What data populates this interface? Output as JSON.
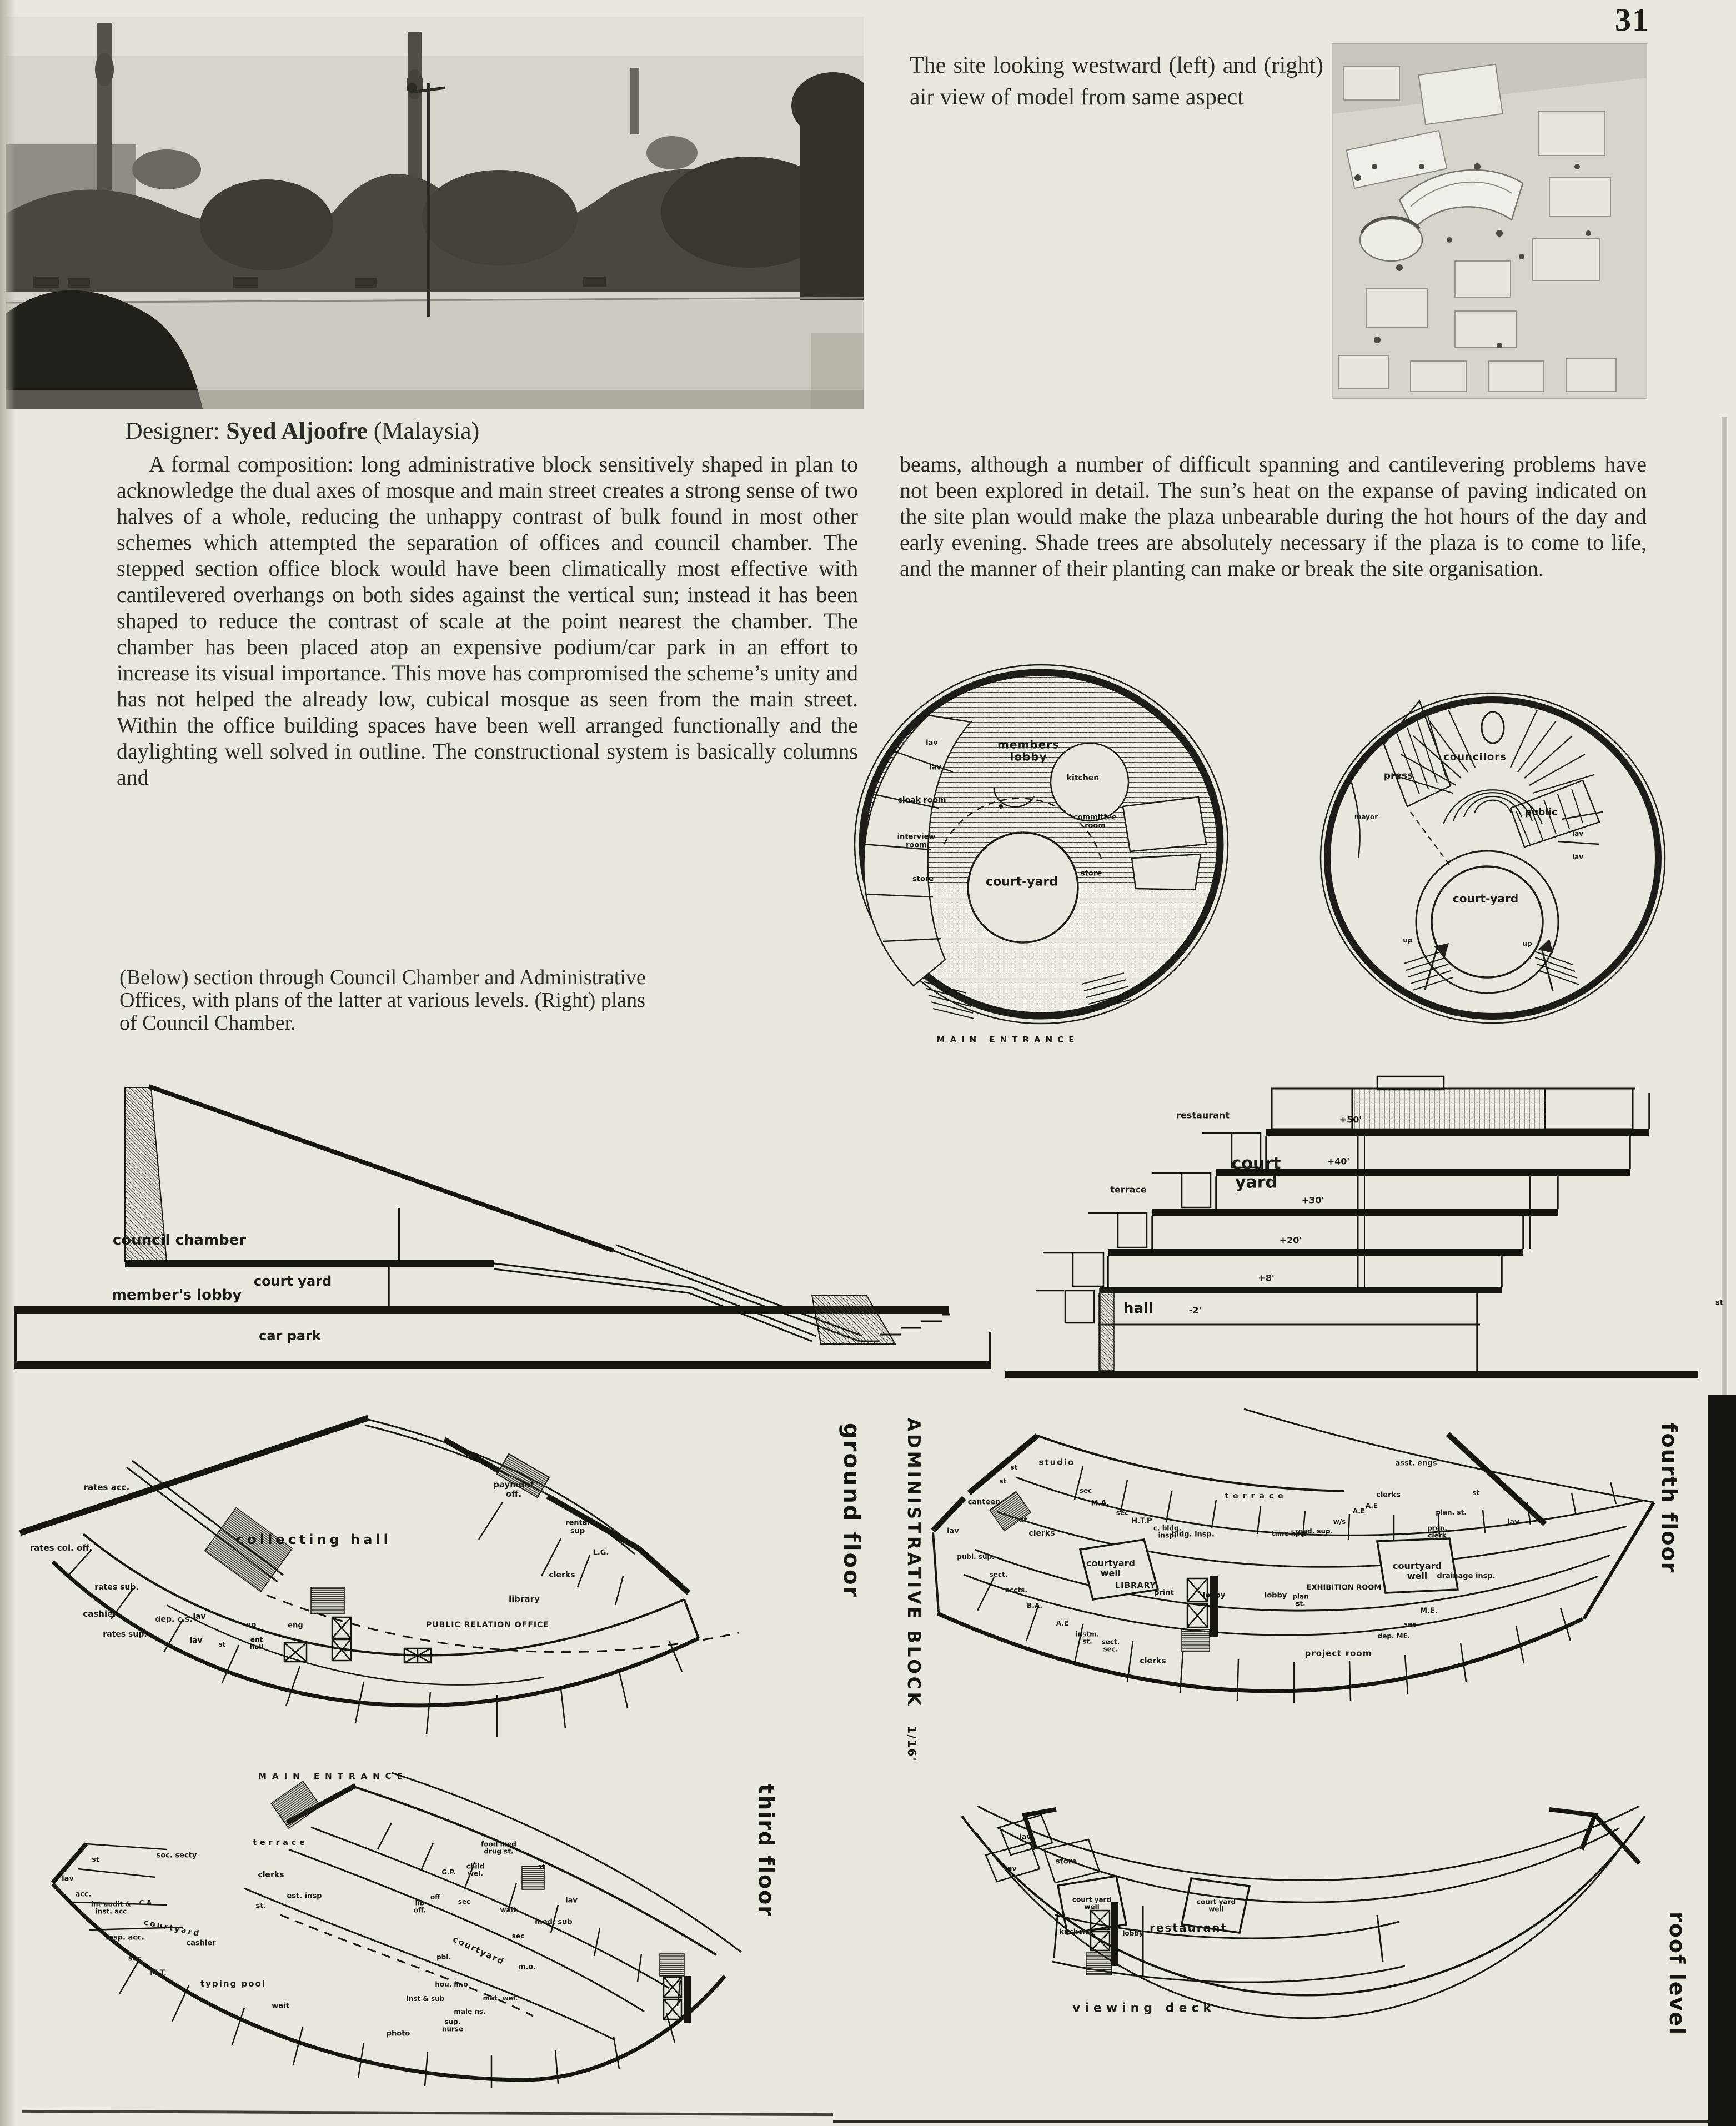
{
  "page_number": "31",
  "photo_caption": "The site looking westward (left) and (right) air view of model from same aspect",
  "designer": {
    "label": "Designer:",
    "name": "Syed Aljoofre",
    "country": "(Malaysia)"
  },
  "body": {
    "left": "A formal composition: long administrative block sensitively shaped in plan to acknowledge the dual axes of mosque and main street creates a strong sense of two halves of a whole, reducing the unhappy contrast of bulk found in most other schemes which attempted the separation of offices and council chamber. The stepped section office block would have been climatically most effective with cantilevered overhangs on both sides against the vertical sun; instead it has been shaped to reduce the contrast of scale at the point nearest the chamber. The chamber has been placed atop an expensive podium/car park in an effort to increase its visual importance. This move has compromised the scheme’s unity and has not helped the already low, cubical mosque as seen from the main street. Within the office building spaces have been well arranged functionally and the daylighting well solved in outline. The constructional system is basically columns and",
    "right": "beams, although a number of difficult spanning and cantilevering problems have not been explored in detail. The sun’s heat on the expanse of paving indicated on the site plan would make the plaza unbearable during the hot hours of the day and early evening. Shade trees are absolutely necessary if the plaza is to come to life, and the manner of their planting can make or break the site organisation."
  },
  "drawings_caption": "(Below) section through Council Chamber and Administrative Offices, with plans of the latter at various levels. (Right) plans of Council Chamber.",
  "council_plans": {
    "left": {
      "labels": [
        "members lobby",
        "lav",
        "lav",
        "cloak room",
        "interview room",
        "store",
        "kitchen",
        "committee room",
        "store",
        "court-yard"
      ],
      "entrance_caption": "MAIN ENTRANCE"
    },
    "right": {
      "labels": [
        "councilors",
        "press",
        "mayor",
        "public",
        "lav",
        "lav",
        "court-yard",
        "up",
        "up"
      ]
    }
  },
  "section": {
    "labels": [
      "council chamber",
      "member's lobby",
      "court yard",
      "car park",
      "terrace",
      "court yard",
      "restaurant",
      "hall"
    ],
    "elevations": [
      "+50'",
      "+40'",
      "+30'",
      "+20'",
      "+8'",
      "-2'"
    ],
    "street": "st"
  },
  "floors": {
    "block_title": "ADMINISTRATIVE BLOCK",
    "block_scale": "1/16'",
    "ground": {
      "title": "ground floor",
      "entrance_caption": "MAIN ENTRANCE",
      "labels": [
        "rates acc.",
        "rates col. off.",
        "collecting hall",
        "rates sub.",
        "cashier",
        "rates sup.",
        "dep. c.s.",
        "lav",
        "lav",
        "st",
        "up",
        "ent hall",
        "eng",
        "payment off.",
        "rental sup",
        "L.G.",
        "clerks",
        "library",
        "PUBLIC RELATION OFFICE"
      ]
    },
    "third": {
      "title": "third floor",
      "labels": [
        "terrace",
        "soc. secty",
        "st",
        "lav",
        "acc.",
        "int audit & inst. acc",
        "C.A",
        "courtyard",
        "insp. acc.",
        "sec",
        "M.T.",
        "cashier",
        "clerks",
        "st.",
        "est. insp",
        "typing pool",
        "wait",
        "food med drug st.",
        "child wel.",
        "G.P.",
        "off",
        "lib off.",
        "sec",
        "st",
        "lav",
        "med. sub",
        "wait",
        "sec",
        "m.o.",
        "courtyard",
        "pbl.",
        "hou. m.o",
        "inst & sub",
        "male ns.",
        "sup. nurse",
        "mat. wel.",
        "photo"
      ]
    },
    "fourth": {
      "title": "fourth floor",
      "labels": [
        "studio",
        "st",
        "st",
        "canteen",
        "lav",
        "st",
        "clerks",
        "publ. sup.",
        "sect.",
        "accts.",
        "B.A.",
        "A.E",
        "instm. st.",
        "sect. sec.",
        "clerks",
        "courtyard well",
        "LIBRARY",
        "print",
        "lobby",
        "sec",
        "M.A.",
        "sec",
        "H.T.P",
        "c. bldg. insp.",
        "bldg. insp.",
        "terrace",
        "asst. engs",
        "clerks",
        "A.E",
        "A.E",
        "w/s",
        "road. sup.",
        "time kprs",
        "st",
        "plan. st.",
        "prep. clerk",
        "lav",
        "drainage insp.",
        "courtyard well",
        "EXHIBITION ROOM",
        "plan st.",
        "lobby",
        "sec",
        "M.E.",
        "dep. ME.",
        "project room"
      ]
    },
    "roof": {
      "title": "roof level",
      "labels": [
        "lav",
        "lav",
        "store",
        "court yard well",
        "kitchen",
        "lobby",
        "restaurant",
        "court yard well",
        "viewing deck"
      ]
    }
  }
}
